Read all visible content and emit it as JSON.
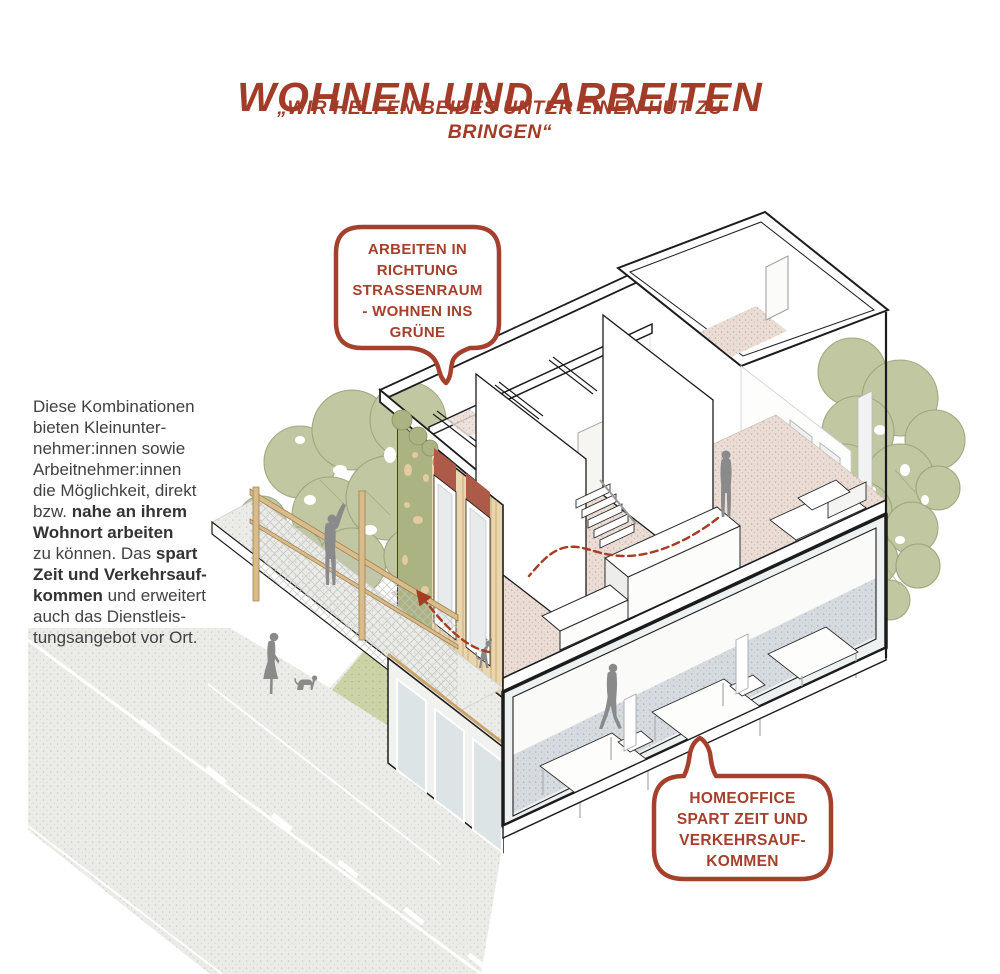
{
  "header": {
    "title": "WOHNEN UND ARBEITEN",
    "subtitle_line1": "„WIR HELFEN BEIDES UNTER EINEN HUT ZU",
    "subtitle_line2": "BRINGEN“"
  },
  "paragraph": {
    "lines": [
      [
        {
          "t": "Diese Kombinationen",
          "b": 0
        }
      ],
      [
        {
          "t": "bieten Kleinunter-",
          "b": 0
        }
      ],
      [
        {
          "t": "nehmer:innen sowie",
          "b": 0
        }
      ],
      [
        {
          "t": "Arbeitnehmer:innen",
          "b": 0
        }
      ],
      [
        {
          "t": "die Möglichkeit, direkt",
          "b": 0
        }
      ],
      [
        {
          "t": "bzw. ",
          "b": 0
        },
        {
          "t": "nahe an ihrem",
          "b": 1
        }
      ],
      [
        {
          "t": "Wohnort arbeiten",
          "b": 1
        }
      ],
      [
        {
          "t": "zu können. Das ",
          "b": 0
        },
        {
          "t": "spart",
          "b": 1
        }
      ],
      [
        {
          "t": "Zeit und Verkehrsauf-",
          "b": 1
        }
      ],
      [
        {
          "t": "kommen",
          "b": 1
        },
        {
          "t": " und erweitert",
          "b": 0
        }
      ],
      [
        {
          "t": "auch das Dienstleis-",
          "b": 0
        }
      ],
      [
        {
          "t": "tungsangebot vor Ort.",
          "b": 0
        }
      ]
    ]
  },
  "bubbles": {
    "street": {
      "lines": [
        "ARBEITEN IN",
        "RICHTUNG",
        "STRASSENRAUM",
        "- WOHNEN INS",
        "GRÜNE"
      ]
    },
    "homeoffice": {
      "lines": [
        "HOMEOFFICE",
        "SPART ZEIT UND",
        "VERKEHRSAUF-",
        "KOMMEN"
      ]
    }
  },
  "colors": {
    "accent_red": "#a5402c",
    "title_red": "#a23b27",
    "text_gray": "#414042",
    "figure_gray": "#8a8a8a",
    "tree_green": "#c0c7a1",
    "tree_outline": "#95a075",
    "grass_green": "#ccd3a6",
    "wood": "#ead6ae",
    "wood_line": "#cdab79",
    "rail_wood": "#d8bc8b",
    "door_accent_panel": "#ad5a49",
    "floor_upper_pink": "#e9ddd6",
    "floor_lower_blue": "#d6dbe0",
    "pavement": "#ebebe8",
    "glass": "#dde4e6",
    "outline": "#1c1c1c"
  }
}
